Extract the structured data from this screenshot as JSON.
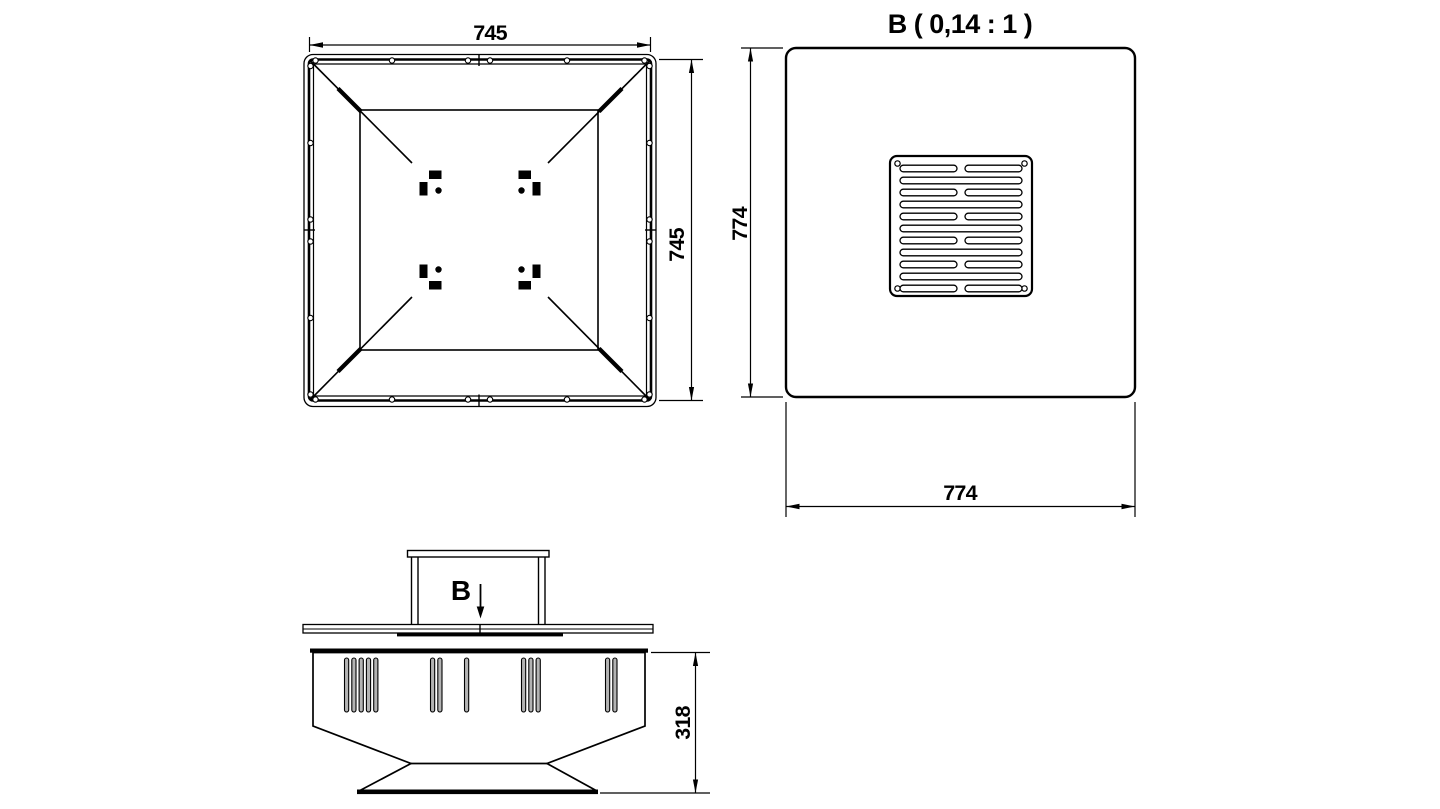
{
  "colors": {
    "background": "#ffffff",
    "line": "#000000",
    "slat_fill": "#b3b3b3"
  },
  "views": {
    "top_view": {
      "width_dim": "745",
      "height_dim": "745"
    },
    "detail_view": {
      "title": "B ( 0,14 : 1 )",
      "width_dim": "774",
      "height_dim": "774"
    },
    "side_view": {
      "section_label": "B",
      "height_dim": "318"
    }
  }
}
